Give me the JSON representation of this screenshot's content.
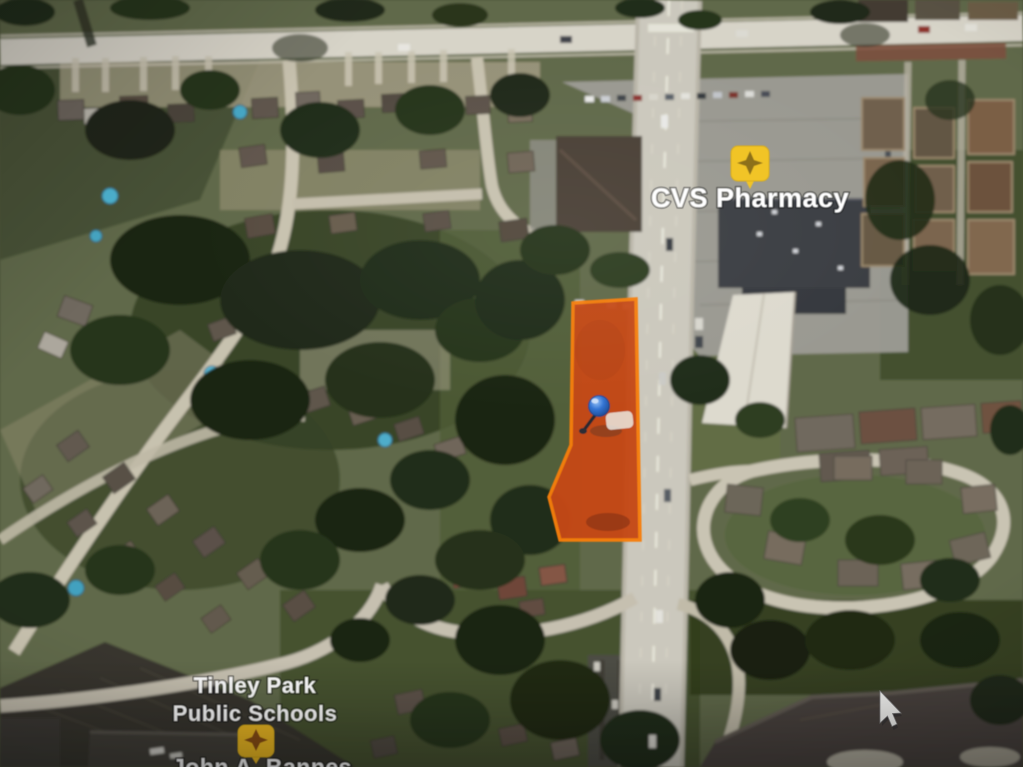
{
  "scene": {
    "type": "aerial-satellite-map-photo",
    "description": "Photographed screen showing satellite imagery with a highlighted parcel"
  },
  "labels": {
    "cvs": {
      "text": "CVS Pharmacy"
    },
    "school": {
      "line1": "Tinley Park",
      "line2": "Public Schools"
    },
    "school_sub": {
      "text": "John A. Bannes"
    },
    "text_color": "#ffffff"
  },
  "markers": {
    "cvs_icon": {
      "name": "yellow-place-marker",
      "color": "#f2c117",
      "glyph_color": "#8a6a08"
    },
    "school_icon": {
      "name": "yellow-place-marker",
      "color": "#f0b816",
      "glyph_color": "#8a4a0c"
    },
    "pin": {
      "name": "blue-pushpin",
      "color": "#2e73d8"
    }
  },
  "parcel": {
    "fill": "#c8430e",
    "stroke": "#fb7b00"
  },
  "cursor": {
    "shape": "arrow",
    "color": "#fafaf8"
  }
}
